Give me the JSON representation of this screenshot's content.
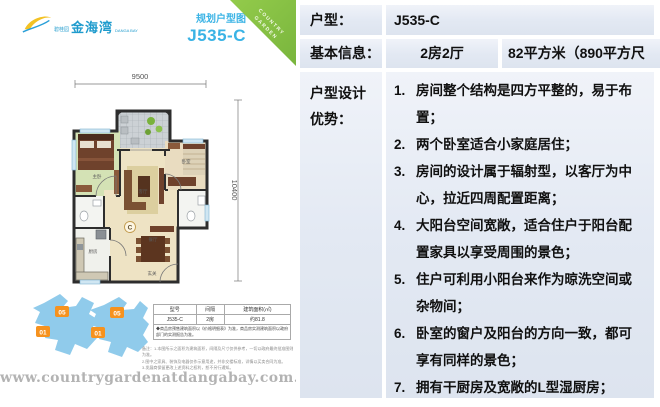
{
  "left_panel": {
    "logo": {
      "brand_small": "碧桂园",
      "brand": "金海湾",
      "brand_sub": "DANGA BAY"
    },
    "corner_ribbon": {
      "line1": "COUNTRY",
      "line2": "GARDEN"
    },
    "plan_header": {
      "subtitle": "规划户型图",
      "unit_code": "J535-C"
    },
    "dimensions": {
      "top": "9500",
      "right": "10400"
    },
    "floorplan": {
      "marker": "C",
      "labels": {
        "master": "主卧",
        "living": "客厅",
        "bedroom": "卧室",
        "dining": "餐厅",
        "kitchen": "厨房",
        "foyer": "玄关"
      }
    },
    "siteplan": {
      "markers": [
        "05",
        "01",
        "05",
        "01"
      ]
    },
    "spec_table": {
      "headers": [
        "型号",
        "间隔",
        "建筑面积(㎡)"
      ],
      "row": [
        "J535-C",
        "2房",
        "约81.8"
      ],
      "note": "◆商品房预售建筑面积以《价格明细表》为准，商品房实测建筑面积以政府部门的实测报告为准。"
    },
    "footnotes": [
      "备注：1.本图所示之面积为建筑面积，间隔及尺寸仅供参考，一切以政府最终批准图则为准。",
      "2.图中之家具、装饰及电器仅作示意用途，并非交楼标准，详情以买卖合同为准。",
      "3.发展商保留更改上述资料之权利，恕不另行通知。"
    ],
    "watermark": "www.countrygardenatdangabay.com.my"
  },
  "info_table": {
    "r1": {
      "label": "户型：",
      "value": "J535-C"
    },
    "r2": {
      "label": "基本信息：",
      "rooms": "2房2厅",
      "area": "82平方米（890平方尺"
    },
    "r3": {
      "label_line1": "户型设计",
      "label_line2": "优势："
    },
    "advantages": [
      {
        "n": "1.",
        "t": "房间整个结构是四方平整的，易于布置；"
      },
      {
        "n": "2.",
        "t": "两个卧室适合小家庭居住；"
      },
      {
        "n": "3.",
        "t": "房间的设计属于辐射型，以客厅为中心，拉近四周配置距离；"
      },
      {
        "n": "4.",
        "t": "大阳台空间宽敞，适合住户于阳台配置家具以享受周围的景色；"
      },
      {
        "n": "5.",
        "t": "住户可利用小阳台来作为晾洗空间或杂物间；"
      },
      {
        "n": "6.",
        "t": "卧室的窗户及阳台的方向一致，都可享有同样的景色；"
      },
      {
        "n": "7.",
        "t": "拥有干厨房及宽敞的L型湿厨房；"
      }
    ]
  },
  "page_number": "114"
}
